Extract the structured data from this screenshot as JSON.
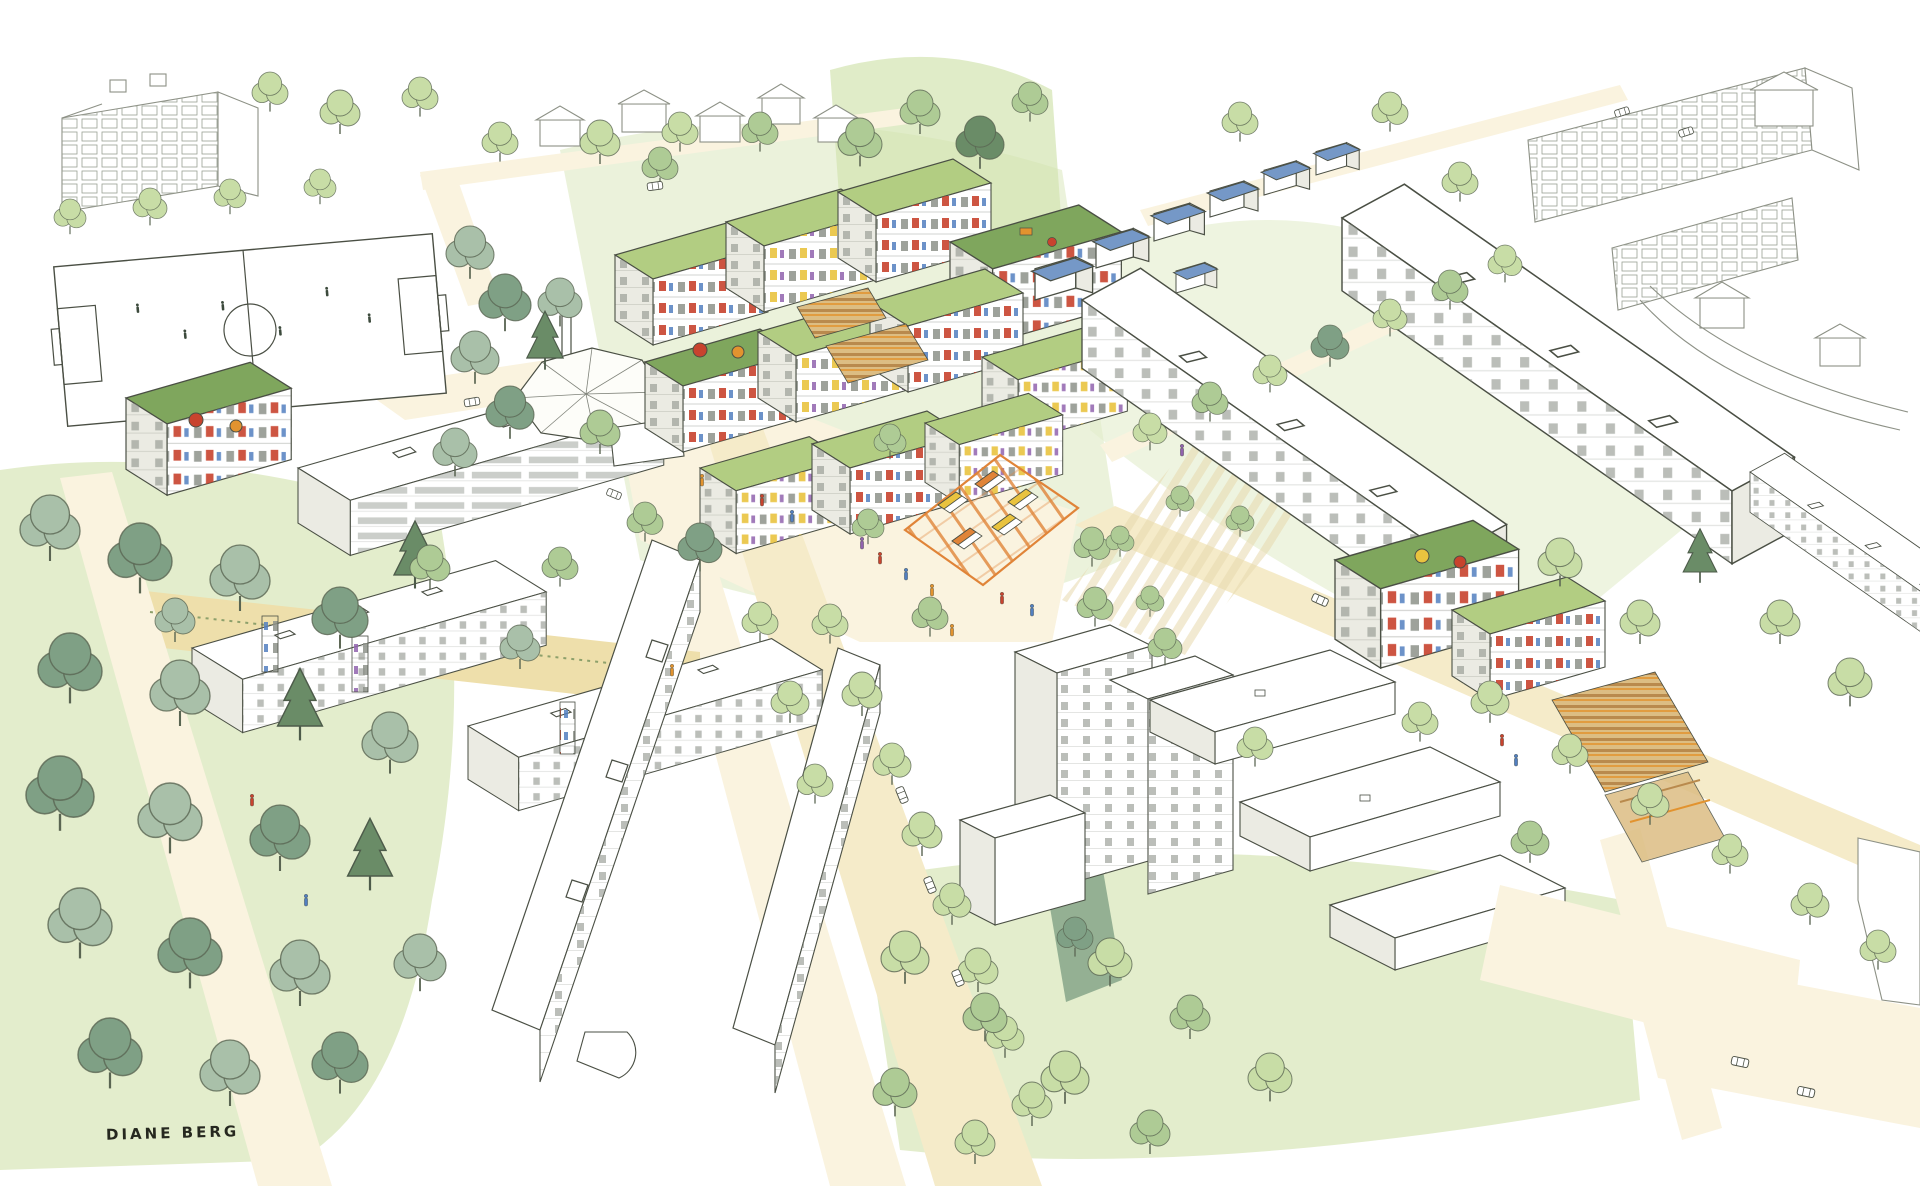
{
  "artwork": {
    "title": "Hand-drawn aerial watercolor illustration of a green residential neighborhood masterplan",
    "style": "ink line work with watercolor wash, bird's-eye axonometric view",
    "signature": "DIANE BERG"
  },
  "palette": {
    "ink": "#4a4f44",
    "paper": "#ffffff",
    "path": "#f5ebc9",
    "path_light": "#faf3df",
    "sand": "#eedfab",
    "lawn": "#e3edcc",
    "lawn2": "#d3e4b0",
    "tree_light": "#c8dda6",
    "tree_mid": "#aecb95",
    "tree_sage": "#a9c0a9",
    "tree_dark": "#7fa085",
    "tree_deep": "#6a8c67",
    "roof_green": "#b2cd82",
    "roof_green_dark": "#7fa65d",
    "solar_blue": "#7598c7",
    "bldg_shade": "#ebebe3",
    "win": "#8d928a",
    "accent_red": "#c8432e",
    "accent_orange": "#e2932f",
    "accent_yellow": "#e9c33f",
    "accent_purple": "#9163ae",
    "accent_blue": "#527fc0",
    "market_orange": "#e08438",
    "allot_tan": "#dcbd83",
    "allot_brown": "#b98a4d"
  },
  "scene": {
    "elements": [
      "soccer-field",
      "church",
      "market-square",
      "green-roof-housing-blocks",
      "solar-roof-row-houses",
      "existing-slab-buildings",
      "white-tower",
      "school-pavilions",
      "allotment-gardens",
      "community-garden-plots",
      "parking-lots",
      "street-trees",
      "left-park",
      "pedestrian-paths",
      "main-street",
      "rooftop-terraces",
      "pedestrians",
      "cars",
      "sketched-context-buildings"
    ]
  }
}
